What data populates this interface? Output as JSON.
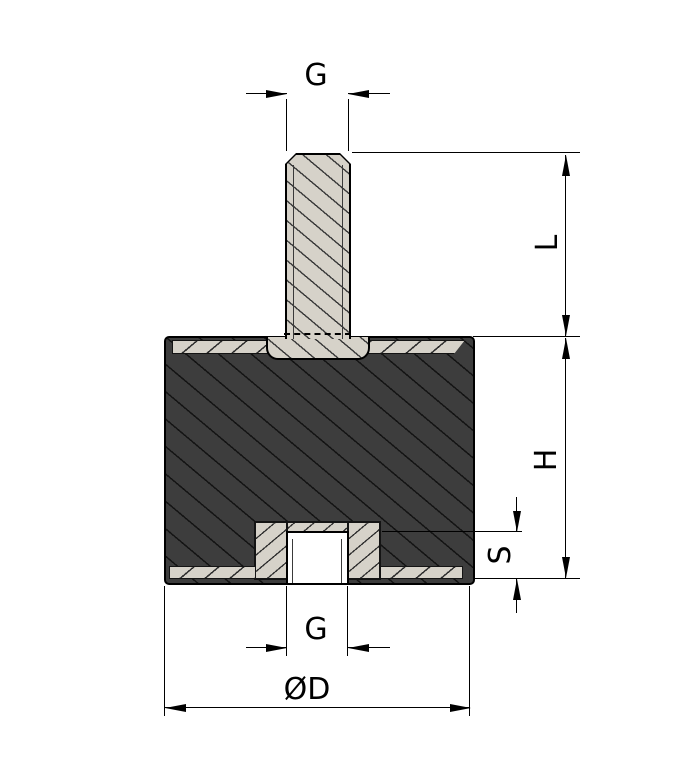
{
  "drawing": {
    "type": "cross-section technical drawing of a cylindrical rubber-metal mount (threaded stud on top, threaded hole in bottom)",
    "labels": {
      "stud_thread": "G",
      "stud_length": "L",
      "body_height": "H",
      "thread_depth": "S",
      "hole_thread": "G",
      "outer_diameter": "ØD"
    },
    "colors": {
      "rubber_fill": "#3d3d3d",
      "metal_fill": "#d6d2c9",
      "line": "#000000",
      "background": "#ffffff"
    }
  }
}
